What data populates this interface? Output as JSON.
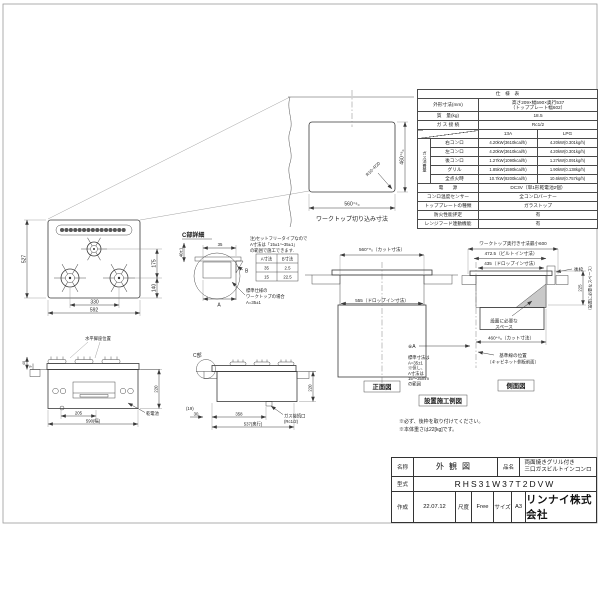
{
  "colors": {
    "line": "#3a3a3a",
    "hatch": "#777777",
    "space_fill": "#c9c9c9"
  },
  "spec": {
    "title": "仕　様　表",
    "dims_label": "外形寸法(mm)",
    "dims_line1": "高さ209×幅590×奥行537",
    "dims_line2": "（トッププレート幅602）",
    "mass_label": "質　量(kg)",
    "mass_value": "18.5",
    "conn_label": "ガ ス 接 続",
    "conn_value": "Rc1/2",
    "col_a": "13A",
    "col_b": "LPG",
    "consumption_label": "ガス消費量",
    "burners": [
      {
        "name": "右コンロ",
        "a": "4.20kW(3610kcal/h)",
        "b": "4.20kW(0.301kg/h)"
      },
      {
        "name": "左コンロ",
        "a": "4.20kW(3610kcal/h)",
        "b": "4.20kW(0.301kg/h)"
      },
      {
        "name": "後コンロ",
        "a": "1.27kW(1090kcal/h)",
        "b": "1.27kW(0.091kg/h)"
      },
      {
        "name": "グリル",
        "a": "1.85kW(1590kcal/h)",
        "b": "1.90kW(0.138kg/h)"
      },
      {
        "name": "全点火時",
        "a": "10.7kW(9200kcal/h)",
        "b": "10.6kW(0.757kg/h)"
      }
    ],
    "power_label": "電　　源",
    "power_value": "DC3V（単1形乾電池2個）",
    "sensor_label": "コンロ温度センサー",
    "sensor_value": "全コンロバーナー",
    "plate_label": "トッププレートの種類",
    "plate_value": "ガラストップ",
    "fire_label": "防火性能評定",
    "fire_value": "有",
    "hood_label": "レンジフード連動機能",
    "hood_value": "有"
  },
  "cutout": {
    "dim_width": "560⁺⁸₀",
    "dim_height": "460⁺⁸₀",
    "radius_note": "R10~R20",
    "caption": "ワークトップ切り込み寸法"
  },
  "plan": {
    "dim_height": "527",
    "dim_right_upper": "175",
    "dim_right_lower": "140",
    "dim_between": "330",
    "dim_width": "592"
  },
  "detail_c": {
    "title": "C部詳細",
    "dim_top": "35",
    "dim_left": "40±1",
    "label_a": "A",
    "label_b": "B",
    "note1": "注)セットフリータイプなので",
    "note2": "A寸法は「15±1〜35±1」",
    "note3": "の範囲で施工できます.",
    "table_a_header": "A寸法",
    "table_b_header": "B寸法",
    "r1a": "35",
    "r1b": "2.5",
    "r2a": "15",
    "r2b": "22.5",
    "std1": "標準仕様の",
    "std2": "ワークトップの場合",
    "std3": "A=35±1"
  },
  "front_section": {
    "dim_cut": "560⁺⁸₀（カット寸法）",
    "dim_drop": "555（ドロップイン寸法）",
    "caption": "正面図"
  },
  "side_section": {
    "dim_min": "ワークトップ奥行き寸法最小600",
    "dim_builtin": "472.5（ビルトイン寸法）",
    "dim_drop": "435（ドロップイン寸法）",
    "rear_frame": "後枠",
    "dim_225": "225",
    "space_note_rot": "（設置に必要なスペース）",
    "space_label1": "設置に必要な",
    "space_label2": "スペース",
    "dim_cut": "460⁺⁸₀（カット寸法）",
    "base1": "基準線の位置",
    "base2": "（キャビネット側板前面）",
    "caption": "側面図"
  },
  "install": {
    "ref_a": "※A",
    "std1": "標準寸法は",
    "std2": "A=35±1",
    "std3": "※但し、",
    "std4": "A寸法は",
    "std5": "15〜35mm",
    "std6": "の範囲",
    "caption": "設置施工例図",
    "note1": "※必ず、後枠を取り付けてください。",
    "note2": "※本体重さは22[kg]です。"
  },
  "front_view": {
    "label_level": "水平脚座位置",
    "dim_205": "205",
    "dim_width": "590(幅)",
    "dim_220": "220",
    "dim_40": "40",
    "dim_9": "9",
    "battery": "乾電池"
  },
  "side_view": {
    "c_marker": "C部",
    "dim_19": "(19)",
    "dim_30": "30",
    "dim_358": "358",
    "dim_depth": "537(奥行)",
    "dim_220": "220",
    "gas1": "ガス接続口",
    "gas2": "(Rc1/2)"
  },
  "titleblock": {
    "name_label": "名称",
    "name_value": "外観図",
    "product_label": "品名",
    "product_line1": "両面焼きグリル付き",
    "product_line2": "三口ガスビルトインコンロ",
    "model_label": "型式",
    "model_value": "RHS31W37T2DVW",
    "date_label": "作成",
    "date_value": "22.07.12",
    "scale_label": "尺度",
    "scale_value": "Free",
    "size_label": "サイズ",
    "size_value": "A3",
    "company": "リンナイ株式会社"
  }
}
